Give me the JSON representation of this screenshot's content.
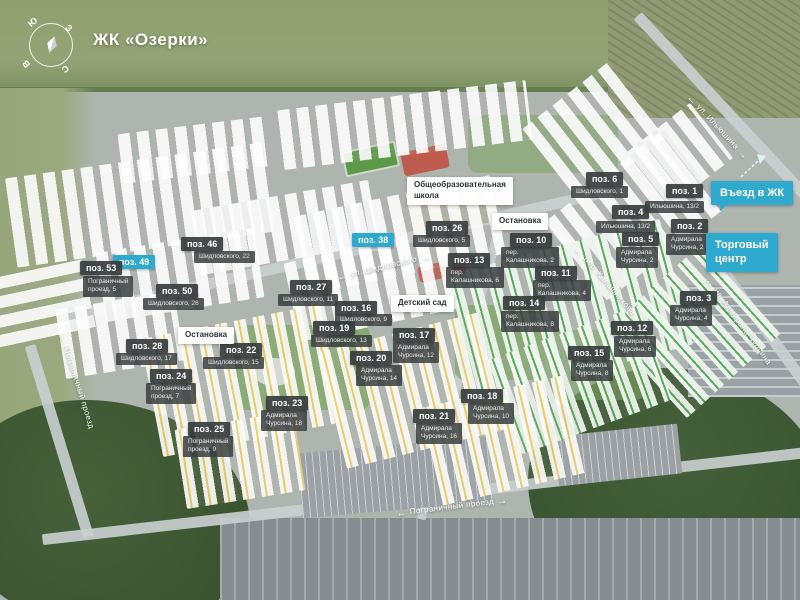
{
  "title": "ЖК «Озерки»",
  "compass": {
    "top_left": "Ю",
    "top_right": "З",
    "bottom_left": "В",
    "bottom_right": "С"
  },
  "colors": {
    "accent": "#2fa9cd",
    "label_dark": "#3a4243",
    "street_text": "#ffffff"
  },
  "pois": [
    {
      "id": "school",
      "type": "white",
      "label": "Общеобразовательная\nшкола",
      "x": 407,
      "y": 177
    },
    {
      "id": "stop-north",
      "type": "white",
      "label": "Остановка",
      "x": 492,
      "y": 213
    },
    {
      "id": "kindergarten",
      "type": "white",
      "label": "Детский сад",
      "x": 391,
      "y": 295
    },
    {
      "id": "stop-west",
      "type": "white",
      "label": "Остановка",
      "x": 178,
      "y": 327
    },
    {
      "id": "entrance",
      "type": "accent",
      "label": "Въезд в ЖК",
      "x": 711,
      "y": 181
    },
    {
      "id": "mall",
      "type": "accent",
      "label": "Торговый\nцентр",
      "x": 706,
      "y": 233
    }
  ],
  "positions": [
    {
      "num": "поз. 1",
      "address": "Ильюшина, 13/2",
      "x": 666,
      "y": 184,
      "ax": 645,
      "ay": 201
    },
    {
      "num": "поз. 2",
      "address": "Адмирала\nЧурсина, 2",
      "x": 671,
      "y": 219,
      "ax": 666,
      "ay": 234
    },
    {
      "num": "поз. 3",
      "address": "Адмирала\nЧурсина, 4",
      "x": 680,
      "y": 291,
      "ax": 670,
      "ay": 305
    },
    {
      "num": "поз. 4",
      "address": "Ильюшина, 13/2",
      "x": 612,
      "y": 205,
      "ax": 596,
      "ay": 221
    },
    {
      "num": "поз. 5",
      "address": "Адмирала\nЧурсина, 2",
      "x": 622,
      "y": 232,
      "ax": 616,
      "ay": 247
    },
    {
      "num": "поз. 6",
      "address": "Шидловского, 1",
      "x": 586,
      "y": 172,
      "ax": 571,
      "ay": 186
    },
    {
      "num": "поз. 10",
      "address": "пер.\nКалашникова, 2",
      "x": 510,
      "y": 233,
      "ax": 501,
      "ay": 247
    },
    {
      "num": "поз. 11",
      "address": "пер.\nКалашникова, 4",
      "x": 535,
      "y": 266,
      "ax": 533,
      "ay": 280
    },
    {
      "num": "поз. 12",
      "address": "Адмирала\nЧурсина, 6",
      "x": 611,
      "y": 321,
      "ax": 614,
      "ay": 336
    },
    {
      "num": "поз. 13",
      "address": "пер.\nКалашникова, 6",
      "x": 448,
      "y": 253,
      "ax": 446,
      "ay": 267
    },
    {
      "num": "поз. 14",
      "address": "пер.\nКалашникова, 8",
      "x": 503,
      "y": 296,
      "ax": 501,
      "ay": 311
    },
    {
      "num": "поз. 15",
      "address": "Адмирала\nЧурсина, 8",
      "x": 568,
      "y": 346,
      "ax": 571,
      "ay": 360
    },
    {
      "num": "поз. 16",
      "address": "Шидловского, 9",
      "x": 335,
      "y": 301,
      "ax": 335,
      "ay": 314
    },
    {
      "num": "поз. 17",
      "address": "Адмирала\nЧурсина, 12",
      "x": 393,
      "y": 328,
      "ax": 393,
      "ay": 342
    },
    {
      "num": "поз. 18",
      "address": "Адмирала\nЧурсина, 10",
      "x": 461,
      "y": 389,
      "ax": 468,
      "ay": 403
    },
    {
      "num": "поз. 19",
      "address": "Шидловского, 13",
      "x": 313,
      "y": 321,
      "ax": 311,
      "ay": 335
    },
    {
      "num": "поз. 20",
      "address": "Адмирала\nЧурсина, 14",
      "x": 350,
      "y": 351,
      "ax": 356,
      "ay": 365
    },
    {
      "num": "поз. 21",
      "address": "Адмирала\nЧурсина, 16",
      "x": 413,
      "y": 409,
      "ax": 416,
      "ay": 423
    },
    {
      "num": "поз. 22",
      "address": "Шидловского, 15",
      "x": 220,
      "y": 343,
      "ax": 203,
      "ay": 357
    },
    {
      "num": "поз. 23",
      "address": "Адмирала\nЧурсина, 18",
      "x": 266,
      "y": 396,
      "ax": 261,
      "ay": 410
    },
    {
      "num": "поз. 24",
      "address": "Пограничный\nпроезд, 7",
      "x": 150,
      "y": 369,
      "ax": 146,
      "ay": 383
    },
    {
      "num": "поз. 25",
      "address": "Пограничный\nпроезд, 9",
      "x": 188,
      "y": 422,
      "ax": 183,
      "ay": 436
    },
    {
      "num": "поз. 26",
      "address": "Шидловского, 5",
      "x": 426,
      "y": 221,
      "ax": 413,
      "ay": 235
    },
    {
      "num": "поз. 27",
      "address": "Шидловского, 11",
      "x": 290,
      "y": 280,
      "ax": 278,
      "ay": 294
    },
    {
      "num": "поз. 28",
      "address": "Шидловского, 17",
      "x": 126,
      "y": 339,
      "ax": 116,
      "ay": 353
    },
    {
      "num": "поз. 38",
      "highlight": true,
      "x": 352,
      "y": 233
    },
    {
      "num": "поз. 46",
      "address": "Шидловского, 22",
      "x": 181,
      "y": 237,
      "ax": 194,
      "ay": 251
    },
    {
      "num": "поз. 49",
      "highlight": true,
      "x": 113,
      "y": 255
    },
    {
      "num": "поз. 50",
      "address": "Шидловского, 26",
      "x": 156,
      "y": 284,
      "ax": 143,
      "ay": 298
    },
    {
      "num": "поз. 53",
      "address": "Пограничный\nпроезд, 5",
      "x": 80,
      "y": 261,
      "ax": 83,
      "ay": 276
    }
  ],
  "streets": [
    {
      "name": "ул. Ильюшина",
      "pre": "←",
      "post": "→",
      "cx": 717,
      "cy": 129,
      "angle": 47,
      "w": 120
    },
    {
      "name": "ул. Шидловского",
      "pre": "←",
      "post": "→",
      "cx": 384,
      "cy": 269,
      "angle": -13,
      "w": 122
    },
    {
      "name": "пер. Калашникова",
      "pre": "←",
      "post": "→",
      "cx": 609,
      "cy": 288,
      "angle": 49,
      "w": 126
    },
    {
      "name": "ул. Адмирала Чурсина",
      "pre": "←",
      "post": "",
      "cx": 737,
      "cy": 322,
      "angle": 54,
      "w": 150
    },
    {
      "name": "Пограничный проезд",
      "pre": "←",
      "post": "",
      "cx": 76,
      "cy": 382,
      "angle": 73,
      "w": 130
    },
    {
      "name": "Пограничный проезд",
      "pre": "←",
      "post": "→",
      "cx": 452,
      "cy": 509,
      "angle": -7,
      "w": 162
    }
  ]
}
